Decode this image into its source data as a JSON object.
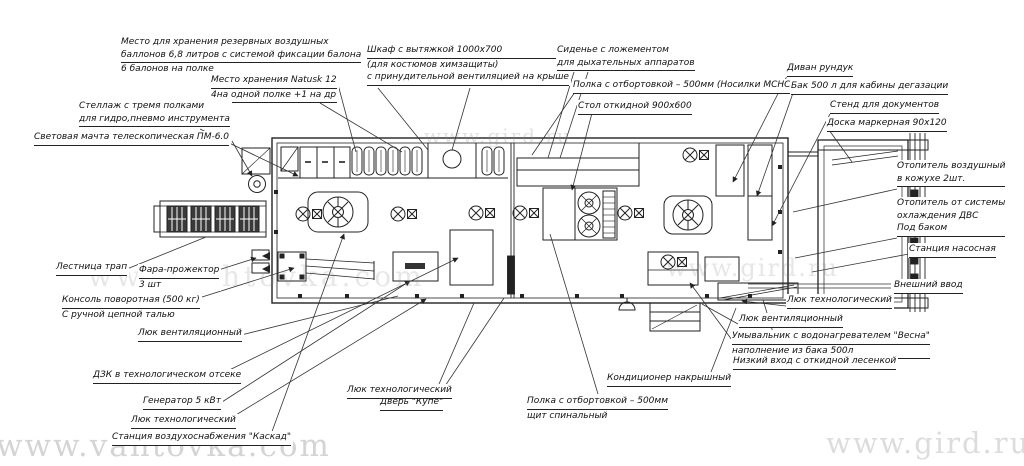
{
  "drawing": {
    "type": "floor-plan",
    "subject": "Мобильный комплекс (вагон-дом) — план размещения оборудования",
    "ink_color": "#222222",
    "background_color": "#ffffff"
  },
  "watermarks": [
    {
      "text": "www.vahtovka.com",
      "position": "bottom-left"
    },
    {
      "text": "www.gird.ru",
      "position": "bottom-right"
    },
    {
      "text": "www.gird.ru",
      "position": "top-middle"
    },
    {
      "text": "www.gird.ru",
      "position": "middle-right"
    },
    {
      "text": "www.vahtovka.com",
      "position": "middle-left"
    }
  ],
  "labels": [
    {
      "name": "reserve-cylinders",
      "lines": [
        "Место для хранения резервных воздушных",
        "баллонов 6,8 литров с системой фиксации балона",
        "6 балонов на полке"
      ]
    },
    {
      "name": "natusk-storage",
      "lines": [
        "Место хранения Natusk 12",
        "4на одной полке +1 на др"
      ]
    },
    {
      "name": "tool-rack",
      "lines": [
        "Стеллаж с тремя полками",
        "для гидро,пневмо инструмента"
      ]
    },
    {
      "name": "light-mast",
      "lines": [
        "Световая мачта телескопическая ПМ-6.0"
      ]
    },
    {
      "name": "exhaust-cabinet",
      "lines": [
        "Шкаф с вытяжкой 1000х700",
        "(для костюмов химзащиты)",
        "с принудительной вентиляцией на крыше"
      ]
    },
    {
      "name": "seat-lodgement",
      "lines": [
        "Сиденье с ложементом",
        "для дыхательных аппаратов"
      ]
    },
    {
      "name": "shelf-msns",
      "lines": [
        "Полка с отбортовкой – 500мм (Носилки МСНС)"
      ]
    },
    {
      "name": "folding-table",
      "lines": [
        "Стол откидной 900х600"
      ]
    },
    {
      "name": "sofa-locker",
      "lines": [
        "Диван рундук"
      ]
    },
    {
      "name": "degassing-tank",
      "lines": [
        "Бак 500 л для кабины дегазации"
      ]
    },
    {
      "name": "document-stand",
      "lines": [
        "Стенд для документов"
      ]
    },
    {
      "name": "marker-board",
      "lines": [
        "Доска маркерная 90х120"
      ]
    },
    {
      "name": "air-heater",
      "lines": [
        "Отопитель воздушный",
        "в кожухе 2шт."
      ]
    },
    {
      "name": "engine-heater",
      "lines": [
        "Отопитель от системы",
        "охлаждения ДВС",
        "Под баком"
      ]
    },
    {
      "name": "pump-station",
      "lines": [
        "Станция насосная"
      ]
    },
    {
      "name": "external-input",
      "lines": [
        "Внешний ввод"
      ]
    },
    {
      "name": "tech-hatch-right",
      "lines": [
        "Люк технологический"
      ]
    },
    {
      "name": "vent-hatch-right",
      "lines": [
        "Люк вентиляционный"
      ]
    },
    {
      "name": "washbasin",
      "lines": [
        "Умывальник с водонагревателем \"Весна\"",
        "наполнение из бака 500л"
      ]
    },
    {
      "name": "low-entrance",
      "lines": [
        "Низкий вход с откидной лесенкой"
      ]
    },
    {
      "name": "roof-ac",
      "lines": [
        "Кондиционер накрышный"
      ]
    },
    {
      "name": "shelf-spinal",
      "lines": [
        "Полка с отбортовкой – 500мм",
        "щит спинальный"
      ]
    },
    {
      "name": "coupe-door",
      "lines": [
        "Дверь \"Купе\""
      ]
    },
    {
      "name": "tech-hatch-mid",
      "lines": [
        "Люк технологический"
      ]
    },
    {
      "name": "kaskad-station",
      "lines": [
        "Станция воздухоснабжения \"Каскад\""
      ]
    },
    {
      "name": "tech-hatch-left",
      "lines": [
        "Люк технологический"
      ]
    },
    {
      "name": "generator",
      "lines": [
        "Генератор 5 кВт"
      ]
    },
    {
      "name": "dzk",
      "lines": [
        "ДЗК в технологическом отсеке"
      ]
    },
    {
      "name": "vent-hatch-left",
      "lines": [
        "Люк вентиляционный"
      ]
    },
    {
      "name": "rotary-console",
      "lines": [
        "Консоль поворотная (500 кг)",
        "С ручной цепной талью"
      ]
    },
    {
      "name": "searchlight",
      "lines": [
        "Фара-прожектор",
        "3 шт"
      ]
    },
    {
      "name": "ladder-gangway",
      "lines": [
        "Лестница трап"
      ]
    }
  ]
}
